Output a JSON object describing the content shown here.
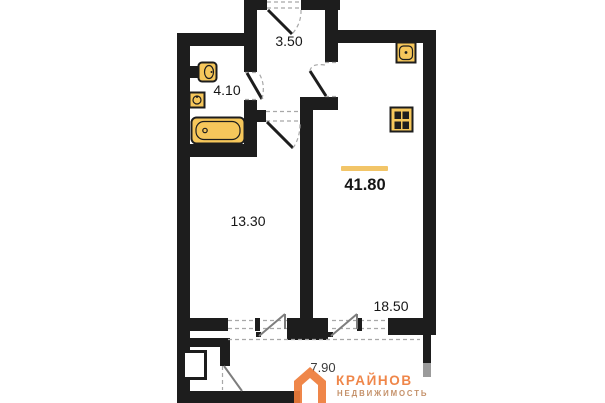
{
  "areas": {
    "hallway": "3.50",
    "bathroom": "4.10",
    "living_room": "13.30",
    "kitchen_living": "18.50",
    "balcony": "7.90",
    "total": "41.80"
  },
  "logo": {
    "brand": "КРАЙНОВ",
    "tagline": "НЕДВИЖИМОСТЬ"
  },
  "colors": {
    "wall": "#1d1d1d",
    "fixture": "#f6c75b",
    "accent": "#f2c568",
    "brand": "#ee7c3a",
    "tagline": "#b06a35",
    "dash": "#a8a8a8",
    "thin_door": "#7d7d7d",
    "balcony_wall": "#9b9b9b"
  }
}
